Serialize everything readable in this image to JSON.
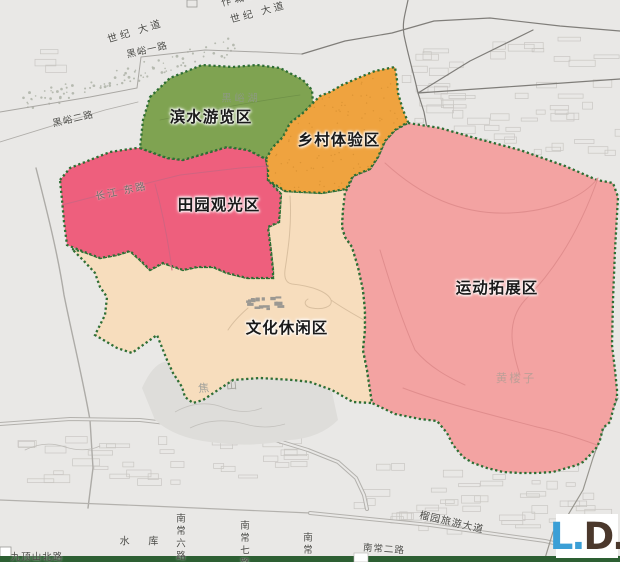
{
  "zones": {
    "binshui": {
      "label": "滨水游览区",
      "color": "#7fa351"
    },
    "xiangcun": {
      "label": "乡村体验区",
      "color": "#efa33f"
    },
    "tianyuan": {
      "label": "田园观光区",
      "color": "#ee5f7d"
    },
    "wenhua": {
      "label": "文化休闲区",
      "color": "#f7ddbd"
    },
    "yundong": {
      "label": "运动拓展区",
      "color": "#f3a3a2"
    },
    "border_color": "#2e6e34"
  },
  "roads": {
    "shiji_1": "世纪 大道",
    "shiji_2": "世纪 大道",
    "heiyu_1": "黑峪一路",
    "heiyu_2": "黑峪二路",
    "changjiang": "长江 东路",
    "liuyuan": "榴园旅游大道",
    "nanchang_2": "南常二路",
    "nanchang_6": "南常六路",
    "nanchang_7": "南常七路",
    "nanchang_partial": "南常",
    "jiudingshan": "九顶山北路"
  },
  "places": {
    "heiyu_lake": "黑峪湖",
    "jiaoshan": "焦 山",
    "huanglouzi": "黄楼子",
    "shuiku": "水 库",
    "top_partial": "作城区"
  },
  "footer": {
    "bar_color": "#2d5f33"
  },
  "logo": {
    "part1": "L.",
    "part2": "D.",
    "color1": "#3b9fd6",
    "color2": "#4b382c"
  }
}
